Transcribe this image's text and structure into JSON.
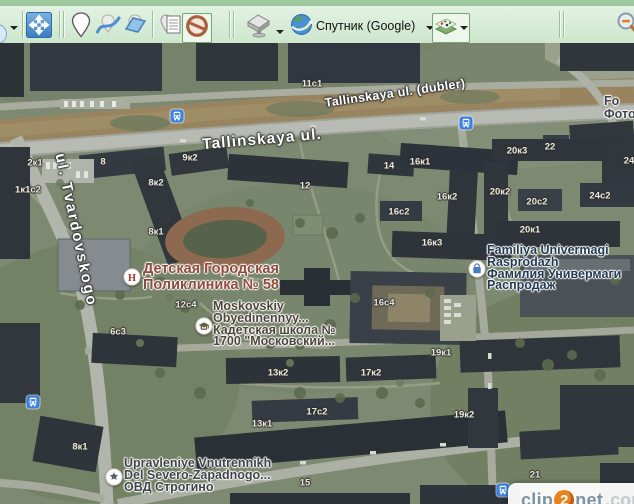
{
  "toolbar": {
    "map_type_label": "Спутник (Google)",
    "buttons": [
      {
        "name": "cropped-left-button",
        "icon": "circle-icon",
        "has_dropdown": true
      },
      {
        "name": "fullscreen-button",
        "icon": "fullscreen-arrows-icon"
      },
      {
        "name": "add-placemark-button",
        "icon": "placemark-icon"
      },
      {
        "name": "add-path-button",
        "icon": "path-icon"
      },
      {
        "name": "add-polygon-button",
        "icon": "polygon-icon"
      },
      {
        "name": "placemark-manager-button",
        "icon": "placemark-list-icon"
      },
      {
        "name": "hide-placemarks-button",
        "icon": "no-entry-icon",
        "active": true
      },
      {
        "name": "download-selection-button",
        "icon": "cache-fill-icon",
        "has_dropdown": true
      },
      {
        "name": "map-source-button",
        "icon": "globe-icon",
        "label": "Спутник (Google)",
        "has_dropdown": true
      },
      {
        "name": "layers-button",
        "icon": "layers-icon",
        "has_dropdown": true,
        "active": true
      },
      {
        "name": "zoom-out-button",
        "icon": "magnifier-minus-icon",
        "cropped": true
      }
    ]
  },
  "map": {
    "street_labels": [
      {
        "text": "Tallinskaya ul. (dubler)",
        "x": 395,
        "y": 50,
        "rotate": -8,
        "size": 12.5,
        "spacing": 0.3
      },
      {
        "text": "Tallinskaya ul.",
        "x": 262,
        "y": 97,
        "rotate": -5,
        "size": 15.5,
        "spacing": 1
      },
      {
        "text": "ul. Tvardovskogo",
        "x": 76,
        "y": 187,
        "rotate": 78,
        "size": 15,
        "spacing": 2
      }
    ],
    "poi_labels": [
      {
        "icon": "hospital",
        "icon_x": 132,
        "icon_y": 234,
        "x": 143,
        "y": 219,
        "size": 14.5,
        "line_height": 15.5,
        "color": "#8e4a3a",
        "lines": [
          "Детская Городская",
          "Поликлиника № 58"
        ]
      },
      {
        "icon": "school",
        "icon_x": 204,
        "icon_y": 283,
        "x": 213,
        "y": 258,
        "size": 12.5,
        "line_height": 11.8,
        "color": "#4d443c",
        "lines": [
          "Moskovskiy",
          "Obyedinennyy...",
          "Кадетская школа №",
          "1700 \"Московский..."
        ]
      },
      {
        "icon": "shopping",
        "icon_x": 477,
        "icon_y": 226,
        "x": 487,
        "y": 202,
        "size": 12.5,
        "line_height": 11.8,
        "color": "#223a52",
        "lines": [
          "Familiya Univermagi",
          "Rasprodazh",
          "Фамилия Универмаги",
          "Распродаж"
        ]
      },
      {
        "icon": "police",
        "icon_x": 114,
        "icon_y": 434,
        "x": 124,
        "y": 415,
        "size": 12.5,
        "line_height": 11.8,
        "color": "#3e4348",
        "lines": [
          "Upravleniye Vnutrennikh",
          "Del Severo-Zapadnogo...",
          "ОВД Строгино"
        ]
      },
      {
        "icon": null,
        "x": 604,
        "y": 52,
        "size": 12.5,
        "line_height": 13,
        "color": "#3e4348",
        "lines": [
          "Fo",
          "Фото"
        ]
      }
    ],
    "building_labels": [
      {
        "text": "2к1",
        "x": 35,
        "y": 120
      },
      {
        "text": "1к1с2",
        "x": 28,
        "y": 147
      },
      {
        "text": "8",
        "x": 103,
        "y": 119
      },
      {
        "text": "9к2",
        "x": 190,
        "y": 115
      },
      {
        "text": "8к2",
        "x": 156,
        "y": 140
      },
      {
        "text": "8к1",
        "x": 156,
        "y": 189
      },
      {
        "text": "11с1",
        "x": 312,
        "y": 41
      },
      {
        "text": "12",
        "x": 305,
        "y": 143
      },
      {
        "text": "14",
        "x": 389,
        "y": 123
      },
      {
        "text": "16к1",
        "x": 420,
        "y": 119
      },
      {
        "text": "16к2",
        "x": 447,
        "y": 154
      },
      {
        "text": "16с2",
        "x": 399,
        "y": 169
      },
      {
        "text": "16к3",
        "x": 432,
        "y": 200
      },
      {
        "text": "16с4",
        "x": 384,
        "y": 260
      },
      {
        "text": "20к3",
        "x": 517,
        "y": 108
      },
      {
        "text": "22",
        "x": 550,
        "y": 104
      },
      {
        "text": "24",
        "x": 629,
        "y": 118
      },
      {
        "text": "20к2",
        "x": 500,
        "y": 149
      },
      {
        "text": "20с2",
        "x": 537,
        "y": 159
      },
      {
        "text": "24с2",
        "x": 600,
        "y": 153
      },
      {
        "text": "20к1",
        "x": 530,
        "y": 187
      },
      {
        "text": "12с4",
        "x": 186,
        "y": 262
      },
      {
        "text": "6с3",
        "x": 118,
        "y": 289
      },
      {
        "text": "13к2",
        "x": 278,
        "y": 330
      },
      {
        "text": "17к2",
        "x": 371,
        "y": 330
      },
      {
        "text": "17с2",
        "x": 317,
        "y": 369
      },
      {
        "text": "13к1",
        "x": 262,
        "y": 381
      },
      {
        "text": "19к1",
        "x": 441,
        "y": 310
      },
      {
        "text": "19к2",
        "x": 464,
        "y": 372
      },
      {
        "text": "8к1",
        "x": 80,
        "y": 404
      },
      {
        "text": "15",
        "x": 305,
        "y": 440
      },
      {
        "text": "21",
        "x": 535,
        "y": 432
      }
    ],
    "transit_stops": [
      {
        "x": 177,
        "y": 73
      },
      {
        "x": 466,
        "y": 80
      },
      {
        "x": 33,
        "y": 359
      },
      {
        "x": 503,
        "y": 447
      }
    ],
    "colors": {
      "toolbar_bg": "#d3e9d3",
      "toolbar_strip": "#9dc89d",
      "accent_green": "#8fb88f",
      "transit_blue": "#3d82e0",
      "street_text": "#ffffff",
      "building_text": "#ece9df",
      "watermark_orange": "#e8821e",
      "watermark_text": "#7e91a3"
    }
  },
  "watermark": {
    "prefix": "clip",
    "badge": "2",
    "suffix": "net",
    "tld": ".com"
  }
}
